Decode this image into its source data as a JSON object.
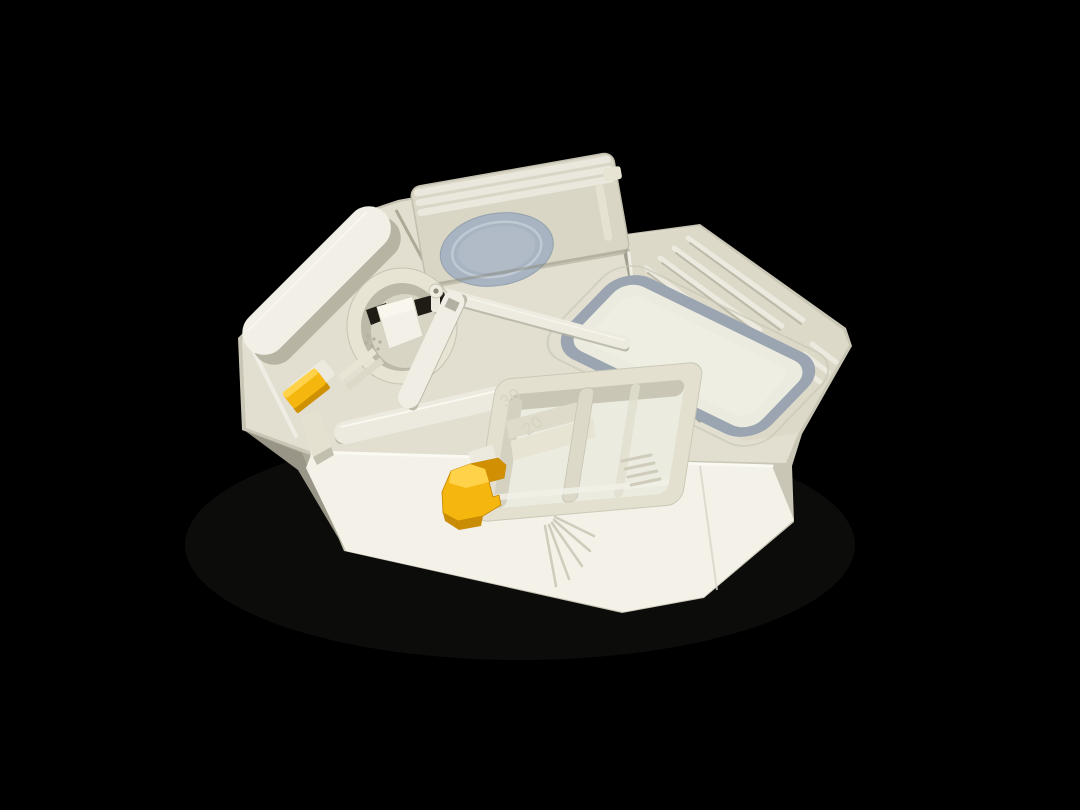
{
  "image": {
    "type": "product-photo",
    "subject": "Dishwasher detergent dispenser unit (plastic spare part) photographed at an angle",
    "background_color": "#000000",
    "embossed_marks": {
      "fill_level_30": "30",
      "fill_level_20": "20"
    },
    "colors": {
      "background": "#000000",
      "body_cream": "#e2dfd0",
      "body_side": "#c9c6b6",
      "body_shadow": "#a8a595",
      "front_white": "#f3f1e8",
      "flap_white": "#f1efe6",
      "rib_light": "#eceadf",
      "disc_gray": "#a8b4c1",
      "disc_gray_light": "#b0bbc7",
      "gasket_gray": "#9aa5b1",
      "latch_yellow": "#f5b60d",
      "latch_yellow_light": "#ffd24a",
      "latch_yellow_dark": "#d18f04",
      "recess_dark": "#1e1c15",
      "emboss_line": "#cfccbb"
    },
    "components": [
      "flap bar",
      "membrane compartment with gray disc",
      "rinse aid well with valve insert",
      "hinge rod",
      "detergent compartment with 30/20 fill marks",
      "lid module with gray gasket",
      "large yellow release latch",
      "small yellow release latch",
      "embossed spray lines",
      "embossed hatch mark"
    ]
  }
}
